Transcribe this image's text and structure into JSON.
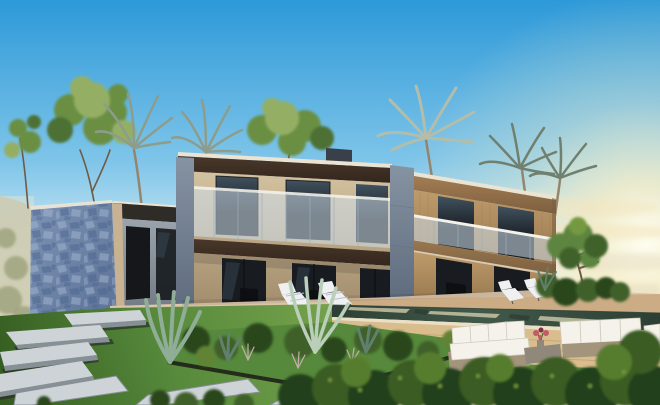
{
  "scene": {
    "type": "architectural-render",
    "subject": "modern-two-storey-villa-exterior-at-sunset",
    "elements": [
      "sky",
      "sun-glow",
      "hill",
      "background-trees",
      "palm-trees",
      "stone-feature-wall",
      "annex-wing",
      "villa-left-block",
      "villa-right-block",
      "glass-balconies",
      "terrace",
      "lounge-chairs",
      "infinity-pool",
      "retaining-wall",
      "lawn",
      "garden-bed",
      "agave-plants",
      "shrubs",
      "stone-path",
      "outdoor-sofa-set",
      "coffee-table",
      "flower-bouquet",
      "foreground-hedges",
      "small-tree"
    ]
  },
  "palette": {
    "skyTop": "#2D99D8",
    "skyMid": "#7FC5E9",
    "skyLow": "#D9EDF4",
    "horizonWarm": "#F6ECC8",
    "sunCore": "#FFFEF2",
    "sunGlow": "#F9EFC8",
    "cloudWarm": "#F2E6C0",
    "hazeSea": "#E7DDC3",
    "hillHaze": "#B7BAA4",
    "hillShrub": "#6D7B52",
    "treeTrunk": "#6E5B43",
    "treeGreenDark": "#4E7134",
    "treeGreen": "#6B8F43",
    "treeGreenLight": "#94AF63",
    "palmTrunk": "#95856C",
    "palmFrond": "#8E9C8C",
    "palmFrondLight": "#B3BDAB",
    "palmFrondDark": "#70806F",
    "parapetLight": "#ECE4D3",
    "roofBox": "#3A4049",
    "fasciaDark": "#4A382B",
    "fasciaDarker": "#33261C",
    "fasciaTan": "#A37D53",
    "fasciaTanDark": "#7D5F3F",
    "stoneBeige": "#D3C2A1",
    "stoneBeigeDark": "#B6A181",
    "stoneBeigeDeep": "#A18C6C",
    "woodPier": "#BF9B6B",
    "woodPierDark": "#97784F",
    "concreteGrey": "#8693A3",
    "concreteGreyDark": "#5E6B7C",
    "annexGrey": "#9BA4AD",
    "annexGreyDark": "#6F7882",
    "annexDark": "#2F2C28",
    "doorDark": "#15171A",
    "glassDark": "#181C21",
    "glassReflect": "#41525F",
    "glassFrame": "#0C0E11",
    "railGlass": "rgba(208,224,236,0.55)",
    "railWhite": "#F3F2EB",
    "railShadow": "#9FB0BC",
    "wallBlue": "#7C93B5",
    "wallBlueDark": "#5B7196",
    "wallJoint": "#47608A",
    "wallHighlight": "#A7B9D3",
    "wallReturn": "#C8B292",
    "terraceFloor": "#DCC6AA",
    "terraceEdge": "#BDA788",
    "deckWood": "#C7A378",
    "poolDark": "#2D3F34",
    "poolWater": "#41594A",
    "poolReflect": "#DAD3B1",
    "copingLight": "#EADFC7",
    "wallTan": "#D9BD8D",
    "wallTanLine": "#B79B6D",
    "lawnLight": "#75A24B",
    "lawn": "#56893B",
    "lawnDark": "#345A20",
    "bedEdge": "#212719",
    "slabTop": "#CED3D8",
    "slabEdge": "#878F97",
    "slabShadow": "#282D27",
    "shrubDark": "#2B461F",
    "shrub": "#3F6029",
    "shrubLight": "#608335",
    "hedgeDark": "#243F1B",
    "hedge": "#3B5B23",
    "hedgeLight": "#577D2D",
    "hedgeLeaf": "#75993F",
    "agave": "#90AD98",
    "agaveDark": "#60806D",
    "agaveLight": "#BACEBA",
    "grassTuft": "#C3B0A9",
    "sofaWhite": "#F4F2EB",
    "sofaShadow": "#D3CDBF",
    "sofaFrame": "#A3947C",
    "tableGrey": "#90897B",
    "flowerPink": "#C15B67",
    "flowerDark": "#7F3141",
    "chairWhite": "#EEF0F2",
    "chairShadow": "#BAC1C9",
    "chairFrame": "#4B5056",
    "treeSmallGreen": "#5D8541",
    "treeSmallDark": "#3F622A",
    "shadeBlack": "#000000"
  }
}
